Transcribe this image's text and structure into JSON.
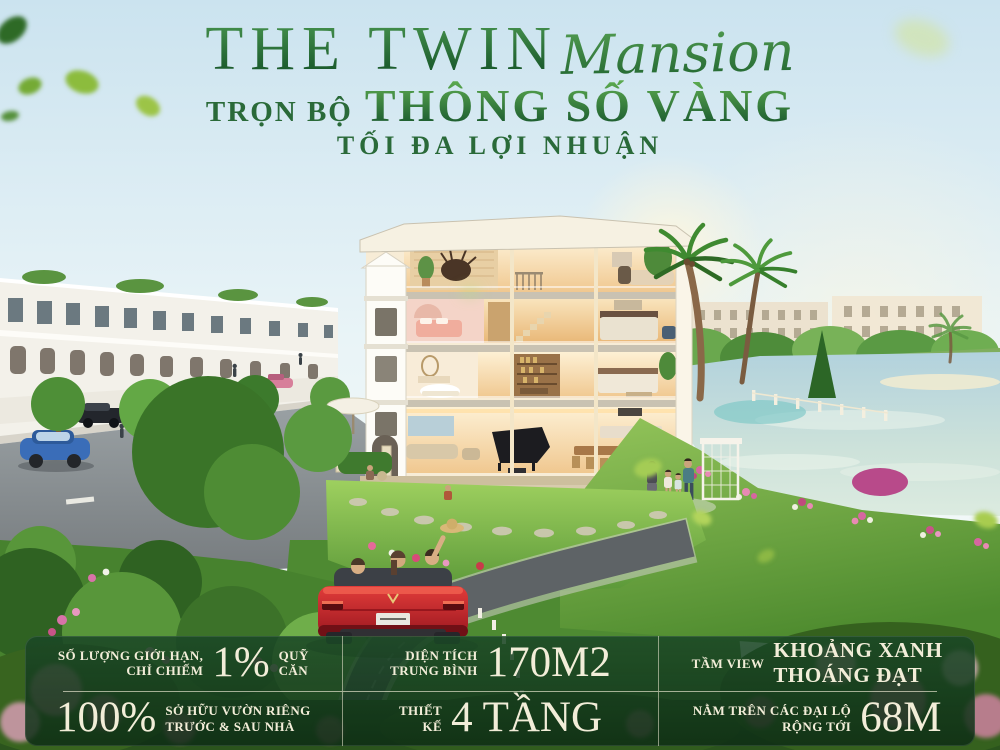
{
  "header": {
    "title_main": "THE TWIN",
    "title_script": "Mansion",
    "subtitle_prefix": "TRỌN BỘ",
    "subtitle_main": "THÔNG SỐ VÀNG",
    "subtitle_secondary": "TỐI ĐA LỢI NHUẬN"
  },
  "stats": {
    "cells": [
      {
        "label1": "SỐ LƯỢNG GIỚI HẠN,",
        "label2": "CHỈ CHIẾM",
        "big": "1%",
        "suffix1": "QUỸ",
        "suffix2": "CĂN"
      },
      {
        "label1": "DIỆN TÍCH",
        "label2": "TRUNG BÌNH",
        "big": "170M2"
      },
      {
        "label1": "TẦM VIEW",
        "suffix1": "KHOẢNG XANH",
        "suffix2": "THOÁNG ĐẠT"
      },
      {
        "big": "100%",
        "suffix1": "SỞ HỮU VƯỜN RIÊNG",
        "suffix2": "TRƯỚC & SAU NHÀ"
      },
      {
        "label1": "THIẾT",
        "label2": "KẾ",
        "big": "4 TẦNG"
      },
      {
        "label1": "NẰM TRÊN CÁC ĐẠI LỘ",
        "label2": "RỘNG TỚI",
        "big": "68M"
      }
    ]
  },
  "colors": {
    "title_green": "#1e6234",
    "accent_green": "#4c9a45",
    "panel_bg": "#1b4826",
    "panel_text": "#f2edd8",
    "car_red": "#cf2930"
  }
}
